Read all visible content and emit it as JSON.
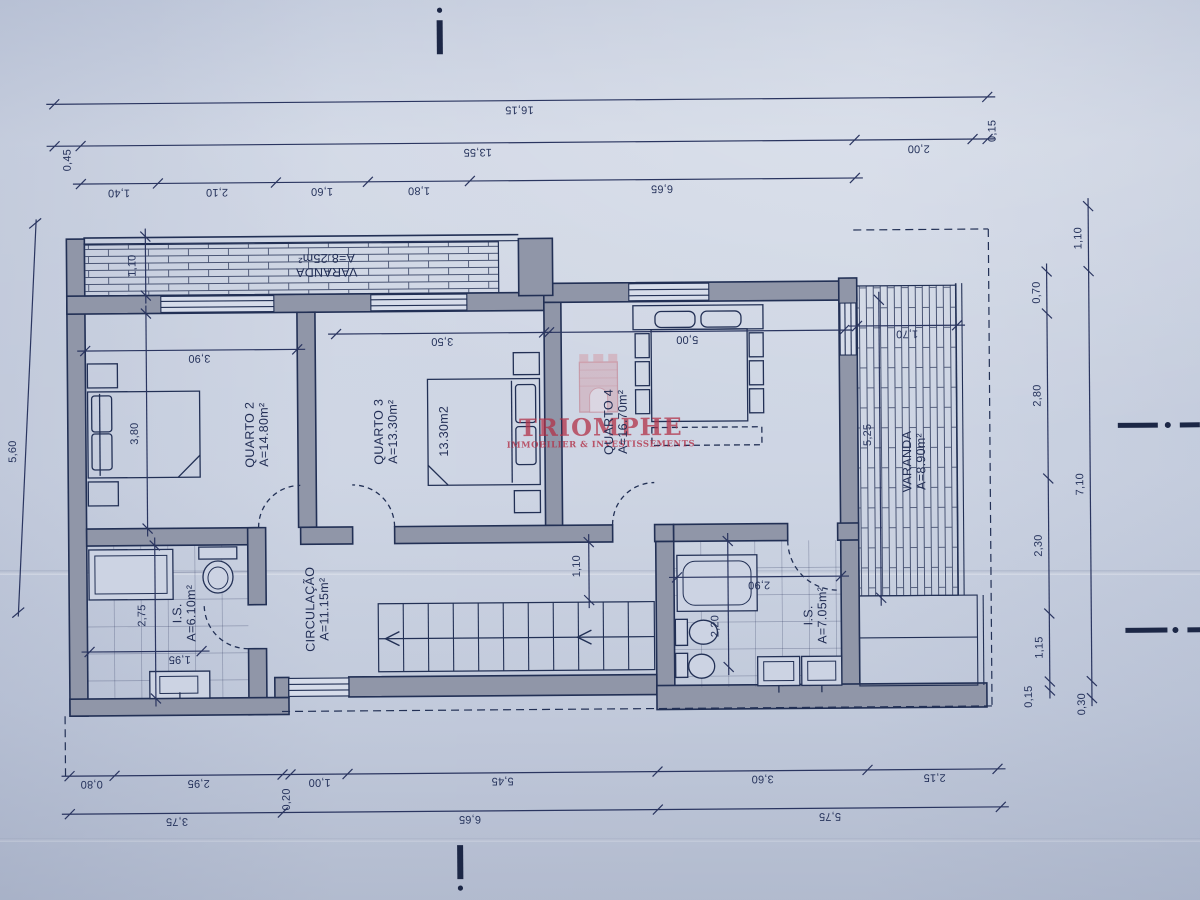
{
  "watermark": {
    "title": "TRIOMPHE",
    "subtitle": "IMMOBILIER & INVESTISSEMENTS",
    "color": "#b13248"
  },
  "rooms": {
    "varanda_top": {
      "label": "VARANDA",
      "area": "A=8.25m²"
    },
    "quarto2": {
      "label": "QUARTO 2",
      "area": "A=14.80m²"
    },
    "quarto3": {
      "label": "QUARTO 3",
      "area": "A=13.30m²"
    },
    "quarto3_bed": {
      "label": "13.30m2"
    },
    "quarto4": {
      "label": "QUARTO 4",
      "area": "A=16.70m²"
    },
    "varanda_right": {
      "label": "VARANDA",
      "area": "A=8.90m²"
    },
    "circulacao": {
      "label": "CIRCULAÇÃO",
      "area": "A=11.15m²"
    },
    "is_left": {
      "label": "I.S.",
      "area": "A=6.10m²"
    },
    "is_right": {
      "label": "I.S.",
      "area": "A=7.05m²"
    }
  },
  "dims": {
    "top": {
      "total": "16,15",
      "row2": [
        "0,45",
        "13,55",
        "2,00",
        "0,15"
      ],
      "row3": [
        "1,40",
        "2,10",
        "1,60",
        "1,80",
        "6,65"
      ]
    },
    "bottom": {
      "row1": [
        "0,80",
        "2,95",
        "0,20",
        "1,00",
        "5,45",
        "3,60",
        "2,15"
      ],
      "row2": [
        "3,75",
        "6,65",
        "5,75"
      ]
    },
    "right": {
      "outer": [
        "1,10",
        "7,10",
        "0,30"
      ],
      "inner": [
        "0,70",
        "2,80",
        "2,30",
        "1,15",
        "0,15"
      ]
    },
    "left": {
      "total": "5,60"
    },
    "interior": {
      "varanda_top_depth": "1,10",
      "q2_w": "3,90",
      "q2_h": "3,80",
      "q3_w": "3,50",
      "q4_w": "5,00",
      "varanda_right_w": "1,70",
      "varanda_right_h": "5,25",
      "hall": "1,10",
      "isl_h": "2,75",
      "isl_w": "1,95",
      "isr_w": "2,90",
      "isr_h": "2,20"
    }
  }
}
